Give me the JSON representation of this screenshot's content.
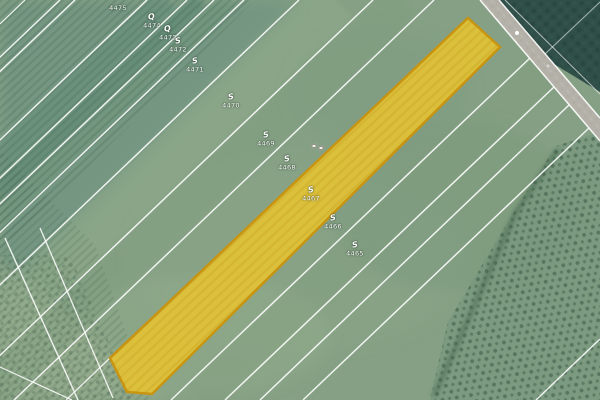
{
  "app": {
    "kind": "aerial cadastral map view",
    "highlighted_parcel": {
      "number": "4467"
    }
  },
  "colors": {
    "highlight_fill": "#E7C431",
    "highlight_border": "#C9930E",
    "boundary_line": "#FFFFFF",
    "field_green": "#85A084",
    "teal_field": "#6A9180",
    "forest_dark": "#2F4F48",
    "road_gray": "#B4B1A9",
    "label_text": "#FFFFFF"
  },
  "parcel_labels": [
    {
      "number": "4475",
      "symbol": "",
      "x": 118,
      "y": 8
    },
    {
      "number": "4474",
      "symbol": "Q",
      "x": 152,
      "y": 21
    },
    {
      "number": "4473",
      "symbol": "Q",
      "x": 168,
      "y": 33
    },
    {
      "number": "4472",
      "symbol": "S",
      "x": 178,
      "y": 45
    },
    {
      "number": "4471",
      "symbol": "S",
      "x": 195,
      "y": 65
    },
    {
      "number": "4470",
      "symbol": "S",
      "x": 231,
      "y": 101
    },
    {
      "number": "4469",
      "symbol": "S",
      "x": 266,
      "y": 139
    },
    {
      "number": "4468",
      "symbol": "S",
      "x": 287,
      "y": 163
    },
    {
      "number": "4467",
      "symbol": "S",
      "x": 311,
      "y": 194
    },
    {
      "number": "4466",
      "symbol": "S",
      "x": 333,
      "y": 222
    },
    {
      "number": "4465",
      "symbol": "S",
      "x": 355,
      "y": 249
    }
  ],
  "building_markers": [
    {
      "x": 314,
      "y": 146
    },
    {
      "x": 321,
      "y": 148
    }
  ],
  "road_vehicle_dots": [
    {
      "x": 517,
      "y": 33,
      "d": 4,
      "color": "#ffffff"
    },
    {
      "x": 548,
      "y": 66,
      "d": 3,
      "color": "#d8d6cf"
    }
  ],
  "icons": {
    "building_marker": "small-white-rectangle",
    "vehicle_dot": "white-circle",
    "landuse_symbols": "Q = orchard/garden glyph, S = meadow glyph"
  }
}
